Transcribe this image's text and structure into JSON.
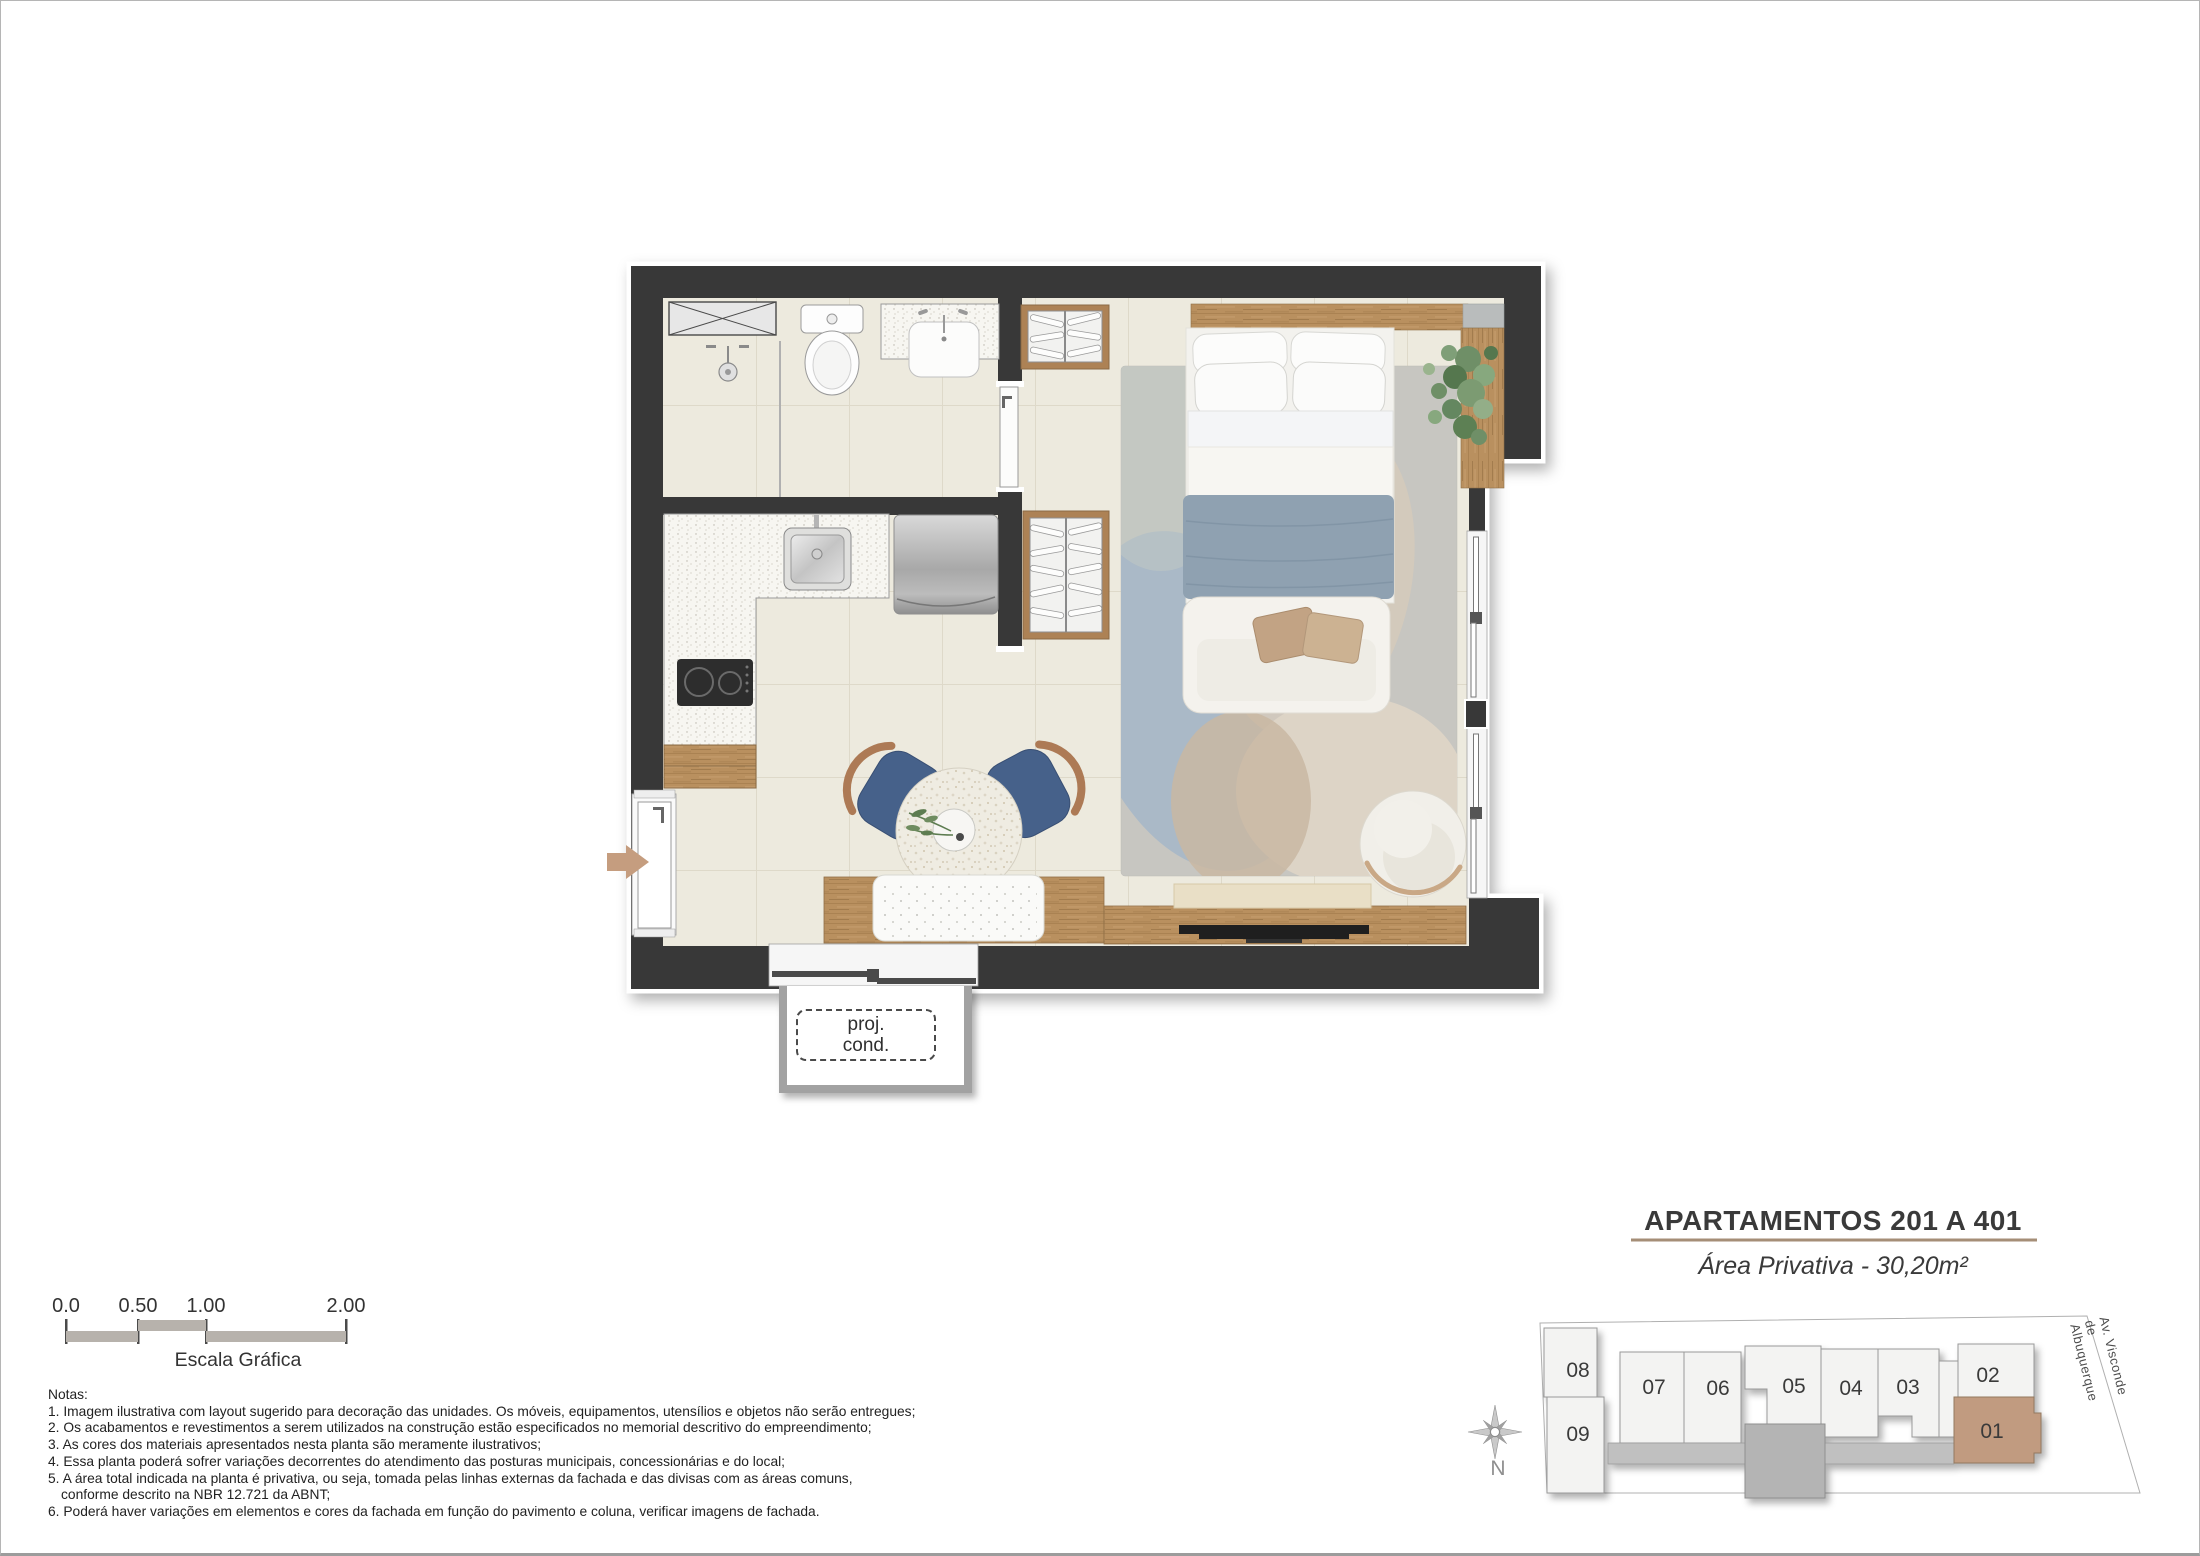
{
  "floor_plan": {
    "balcony_label": {
      "line1": "proj.",
      "line2": "cond."
    }
  },
  "scale_bar": {
    "labels": [
      "0.0",
      "0.50",
      "1.00",
      "2.00"
    ],
    "caption": "Escala Gráfica"
  },
  "notes": {
    "heading": "Notas:",
    "lines": [
      "1. Imagem ilustrativa com layout sugerido para decoração das unidades. Os móveis, equipamentos, utensílios e objetos não serão entregues;",
      "2. Os acabamentos e revestimentos a serem utilizados na construção estão especificados no memorial descritivo do empreendimento;",
      "3. As cores dos materiais apresentados nesta planta são meramente ilustrativos;",
      "4. Essa planta poderá sofrer variações decorrentes do atendimento das posturas municipais, concessionárias e do local;",
      "5. A área total indicada na planta é privativa, ou seja, tomada pelas linhas externas da fachada e das divisas com as áreas comuns,",
      "conforme descrito na NBR 12.721 da ABNT;",
      "6. Poderá haver variações em elementos e cores da fachada em função do pavimento e coluna, verificar imagens de fachada."
    ]
  },
  "title_block": {
    "title": "APARTAMENTOS 201 A 401",
    "subtitle": "Área Privativa - 30,20m²"
  },
  "key_plan": {
    "units": [
      {
        "label": "08"
      },
      {
        "label": "09"
      },
      {
        "label": "07"
      },
      {
        "label": "06"
      },
      {
        "label": "05"
      },
      {
        "label": "04"
      },
      {
        "label": "03"
      },
      {
        "label": "02"
      },
      {
        "label": "01"
      }
    ],
    "highlighted_unit": "01",
    "highlight_color": "#c19b80",
    "north_label": "N",
    "street_label": "Av. Visconde de Albuquerque"
  },
  "colors": {
    "wall": "#383838",
    "floor": "#edeade",
    "wood": "#b9905f",
    "rug": "#c7c6c1",
    "blanket": "#8fa1b1",
    "chair_blue": "#46618a",
    "entry_arrow": "#c59d7f"
  }
}
